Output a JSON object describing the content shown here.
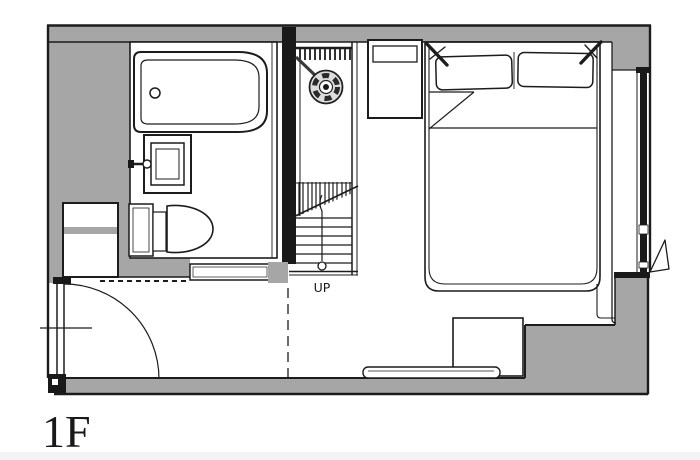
{
  "plan": {
    "floor_label": "1F",
    "up_label": "UP"
  },
  "colors": {
    "wall": "#a6a6a6",
    "line": "#1c1c1c",
    "ink": "#191919",
    "paper": "#ffffff",
    "metal": "#dddddd",
    "strip": "#f3f3f3"
  }
}
